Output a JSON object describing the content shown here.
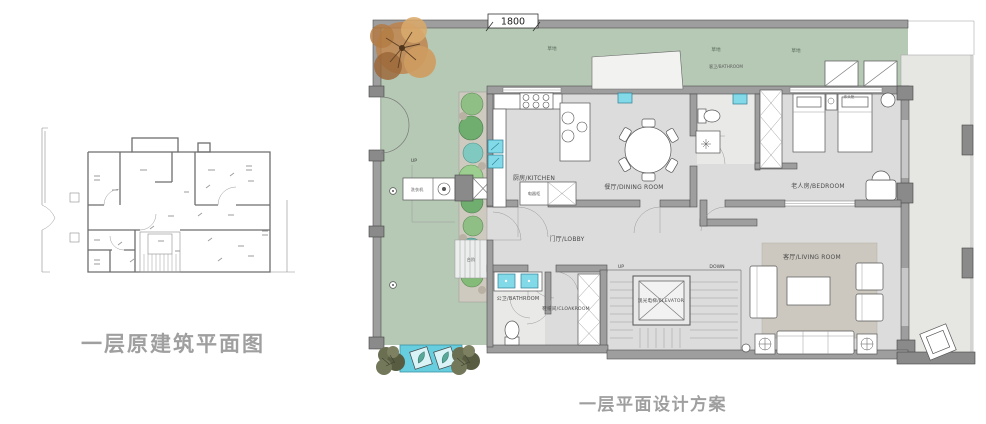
{
  "left_plan": {
    "title": "一层原建筑平面图"
  },
  "right_plan": {
    "title": "一层平面设计方案",
    "top_dimension": "1800",
    "labels": {
      "grass_1": "草地",
      "grass_2": "草地",
      "grass_3": "草地",
      "kitchen": "厨房/KITCHEN",
      "dining_room": "餐厅/DINING ROOM",
      "guest_bathroom": "客卫/BATHROOM",
      "bedroom": "老人房/BEDROOM",
      "lobby": "门厅/LOBBY",
      "public_bathroom": "公卫/BATHROOM",
      "cloakroom": "鞋帽间/CLOAKROOM",
      "elevator": "观光电梯/ELEVATOR",
      "living_room": "客厅/LIVING ROOM",
      "washing_machine": "洗衣机",
      "steps": "台阶",
      "appliance_cabinet": "电器柜",
      "bedside": "床头柜",
      "up_garden": "UP",
      "up_stairs": "UP",
      "down_stairs": "DOWN"
    },
    "colors": {
      "lawn": "#b6c9b5",
      "floor": "#dcdcdc",
      "wall": "#9e9e9e",
      "fixture_blue": "#82d9e8",
      "water_feature": "#66cede",
      "rug": "#ccc8bf",
      "tree_autumn": "#c9894e",
      "shrub": "#64684c",
      "title_gray": "#9f9f9f"
    }
  }
}
